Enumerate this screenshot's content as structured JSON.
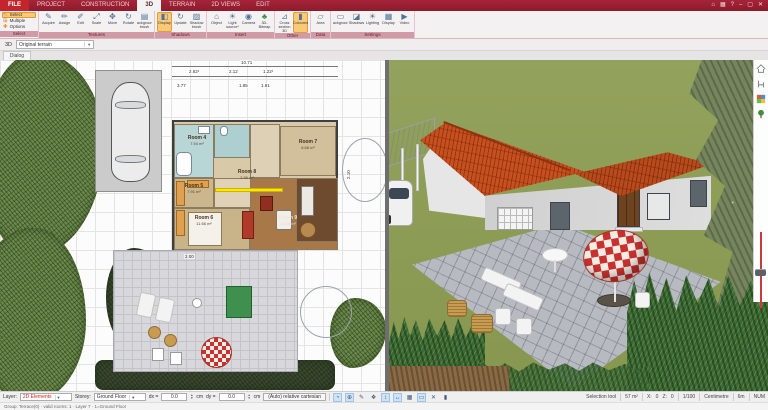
{
  "window": {
    "tabs": [
      {
        "label": "FILE"
      },
      {
        "label": "PROJECT"
      },
      {
        "label": "CONSTRUCTION"
      },
      {
        "label": "3D"
      },
      {
        "label": "TERRAIN"
      },
      {
        "label": "2D VIEWS"
      },
      {
        "label": "EDIT"
      }
    ],
    "active_tab": "3D"
  },
  "ribbon": {
    "select_group": {
      "label": "Select",
      "items": [
        "Select",
        "Multiple",
        "Options"
      ]
    },
    "textures_group": {
      "label": "Textures",
      "buttons": [
        "Acquire",
        "Assign",
        "Edit",
        "Scale",
        "Move",
        "Rotate",
        "Background brush"
      ]
    },
    "shadows_group": {
      "label": "Shadows",
      "buttons": [
        "Display",
        "Update",
        "Shadow brush"
      ]
    },
    "insert_group": {
      "label": "Insert",
      "buttons": [
        "Object",
        "Light source*",
        "Camera",
        "3D-Bitmap"
      ]
    },
    "other_group": {
      "label": "Other",
      "buttons": [
        "Cross section 3D",
        "Coloured"
      ]
    },
    "data_group": {
      "label": "Data",
      "buttons": [
        "Area"
      ]
    },
    "settings_group": {
      "label": "Settings",
      "buttons": [
        "Background",
        "Shadows",
        "Lighting",
        "Display",
        "Video"
      ]
    }
  },
  "view_toolbar": {
    "mode_label": "3D",
    "terrain_select": "Original terrain",
    "dialog_tab": "Dialog"
  },
  "plan": {
    "dims": {
      "total": "10.71",
      "d1": "2.62¹",
      "d2": "2.12",
      "d3": "1.22¹",
      "d4": "3.77",
      "d5": "1.85",
      "d6": "1.91",
      "d7": "2.00",
      "d8": "2.10"
    },
    "rooms": {
      "room4": {
        "name": "Room 4",
        "area": "7.94 m²"
      },
      "room5": {
        "name": "Room 5",
        "area": "7.91 m²"
      },
      "room6": {
        "name": "Room 6",
        "area": "11.66 m²"
      },
      "room7": {
        "name": "Room 7",
        "area": "8.68 m²"
      },
      "room8": {
        "name": "Room 8",
        "area": "2.96 m²"
      },
      "room9": {
        "name": "Room 9",
        "area": "17.88 m²"
      }
    }
  },
  "statusbar": {
    "layer_label": "Layer:",
    "layer_value": "2D Elements",
    "storey_label": "Storey:",
    "storey_value": "Ground Floor",
    "dx_label": "dx =",
    "dx_value": "0.0",
    "dx_unit": "cm",
    "dy_label": "dy =",
    "dy_value": "0.0",
    "dy_unit": "cm",
    "mode_button": "(Auto) relative cartesian",
    "tool": "Selection tool",
    "measure": "57 m²",
    "x_label": "X:",
    "x_value": "0",
    "z_label": "Z:",
    "z_value": "0",
    "scale": "1/100",
    "unit": "Centimetre",
    "grid": "6m",
    "num": "NUM",
    "info_line": "Group: Terrace(0) · valid rooms: 1 · Layer 7 · 1=Ground Floor"
  },
  "colors": {
    "ribbon_maroon": "#9c1f33",
    "file_tab_red": "#c3252c",
    "active_highlight": "#f9c978",
    "selection_yellow": "#ffe600",
    "roof_orange": "#c8501e",
    "terrain_green": "#8d9d58",
    "hedge_green": "#3c6a33",
    "patio_gray": "#b7bac0",
    "layer_text_red": "#cc2222",
    "slider_red": "#cc3b3b"
  }
}
